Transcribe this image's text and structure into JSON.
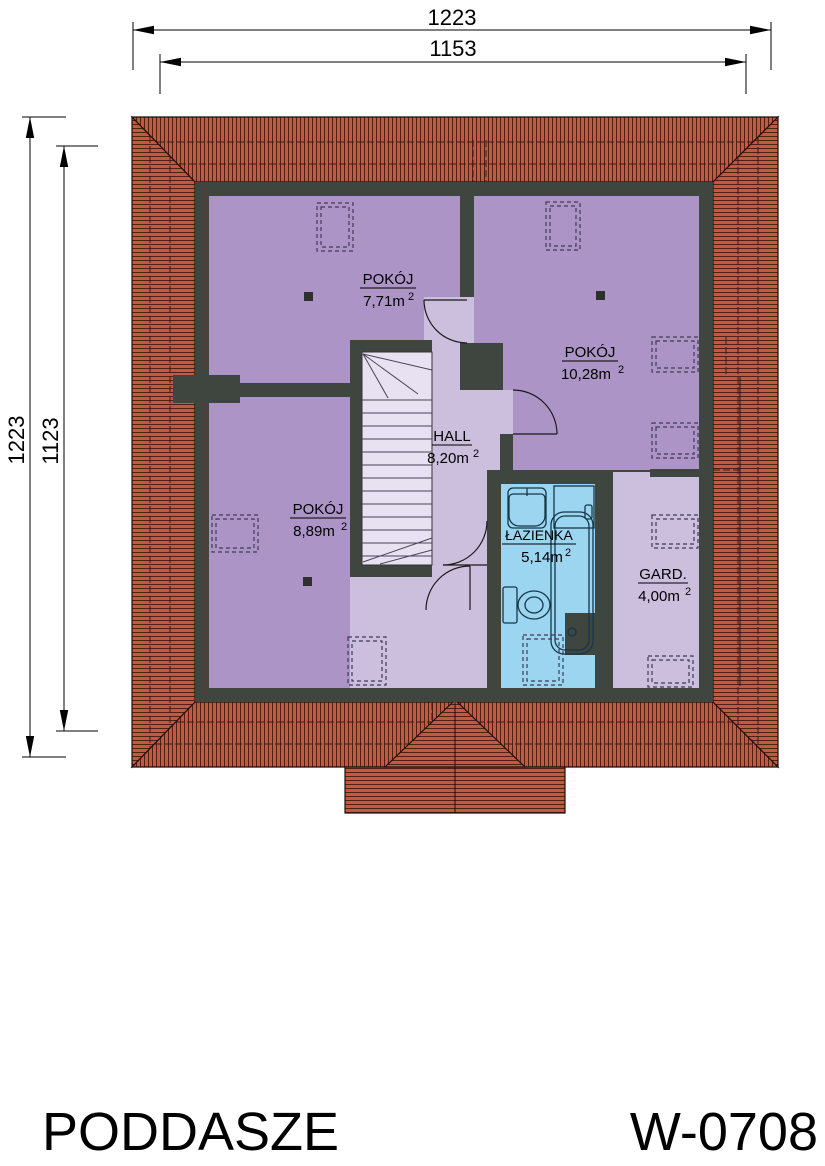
{
  "dimensions": {
    "top_outer": "1223",
    "top_inner": "1153",
    "left_outer": "1223",
    "left_inner": "1123"
  },
  "rooms": {
    "pokoj1": {
      "name": "POKÓJ",
      "area": "7,71m",
      "sup": "2"
    },
    "pokoj2": {
      "name": "POKÓJ",
      "area": "10,28m",
      "sup": "2"
    },
    "pokoj3": {
      "name": "POKÓJ",
      "area": "8,89m",
      "sup": "2"
    },
    "hall": {
      "name": "HALL",
      "area": "8,20m",
      "sup": "2"
    },
    "lazienka": {
      "name": "ŁAZIENKA",
      "area": "5,14m",
      "sup": "2"
    },
    "gard": {
      "name": "GARD.",
      "area": "4,00m",
      "sup": "2"
    }
  },
  "footer": {
    "floor_label": "PODDASZE",
    "plan_code": "W-0708"
  },
  "colors": {
    "roof": "#c4593f",
    "roof_line": "#401a10",
    "wall": "#3f453f",
    "room_purple": "#ac95c6",
    "hall_lilac": "#cbbfdd",
    "bath_blue": "#9bd5ef",
    "stairs": "#e8e1f1"
  }
}
